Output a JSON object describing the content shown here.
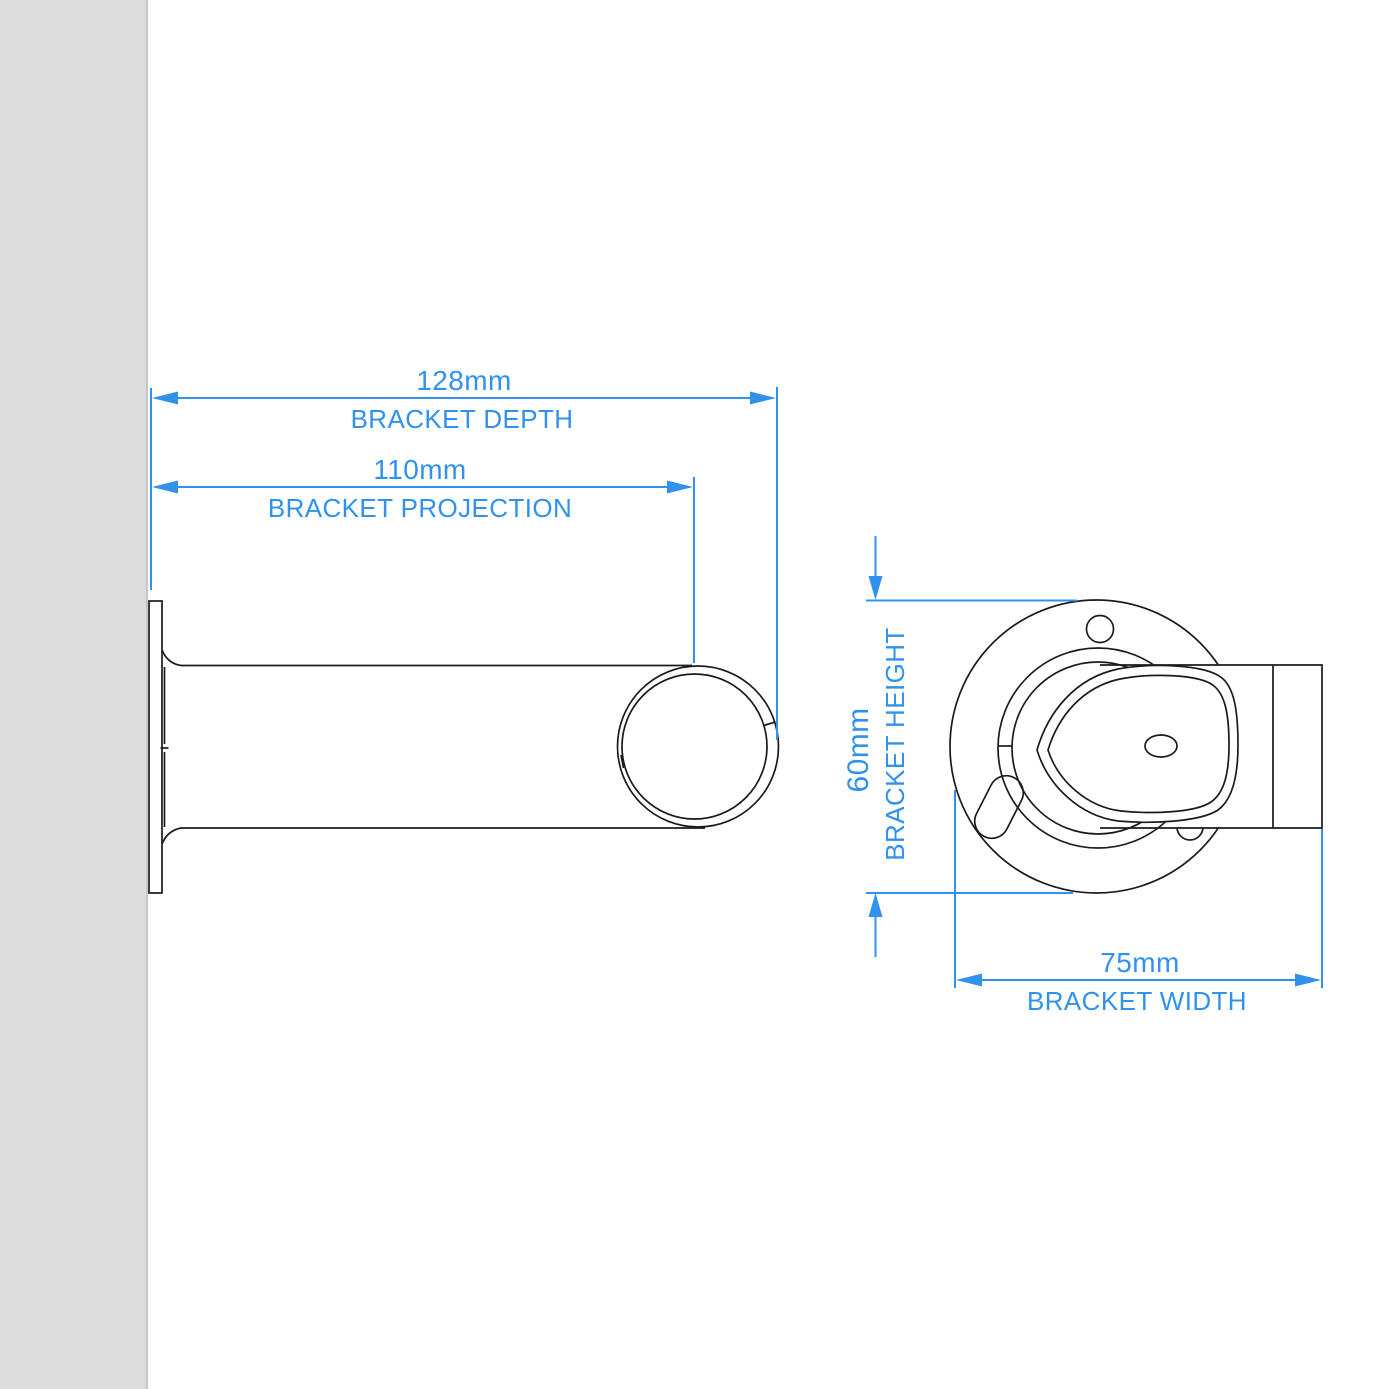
{
  "drawing": {
    "type": "technical-dimension-diagram",
    "subject": "curtain pole wall bracket, side view and front view"
  },
  "dimensions": {
    "depth": {
      "value": "128mm",
      "label": "BRACKET DEPTH"
    },
    "projection": {
      "value": "110mm",
      "label": "BRACKET PROJECTION"
    },
    "height": {
      "value": "60mm",
      "label": "BRACKET HEIGHT"
    },
    "width": {
      "value": "75mm",
      "label": "BRACKET WIDTH"
    }
  },
  "colors": {
    "dimension_blue": "#3092EC",
    "line_black": "#1B1B1B",
    "wall_gray": "#DCDCDC",
    "background": "#FFFFFF"
  }
}
